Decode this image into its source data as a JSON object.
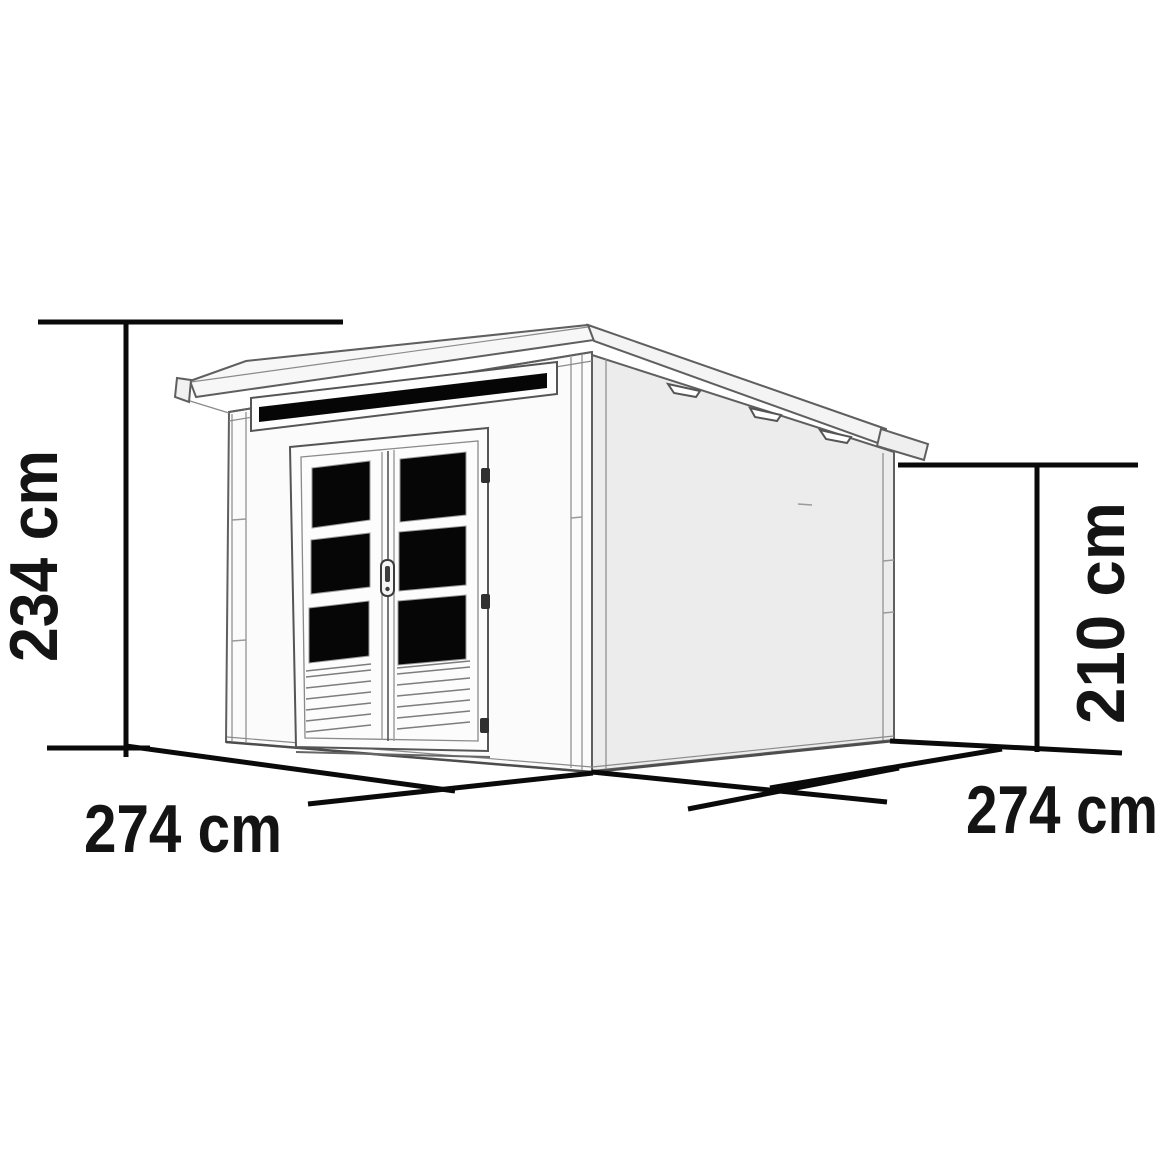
{
  "diagram": {
    "title": "Garden shed pent-roof dimension drawing",
    "dimensions": {
      "overall_height": "234 cm",
      "wall_height": "210 cm",
      "front_width": "274 cm",
      "side_depth": "274 cm"
    },
    "colors": {
      "dimension_line": "#0a0a0a",
      "shed_outline": "#5f5f5f",
      "front_wall": "#fbfbfb",
      "side_wall": "#ececec",
      "roof_face": "#f7f7f7",
      "glass": "#060606",
      "background": "#ffffff"
    }
  }
}
